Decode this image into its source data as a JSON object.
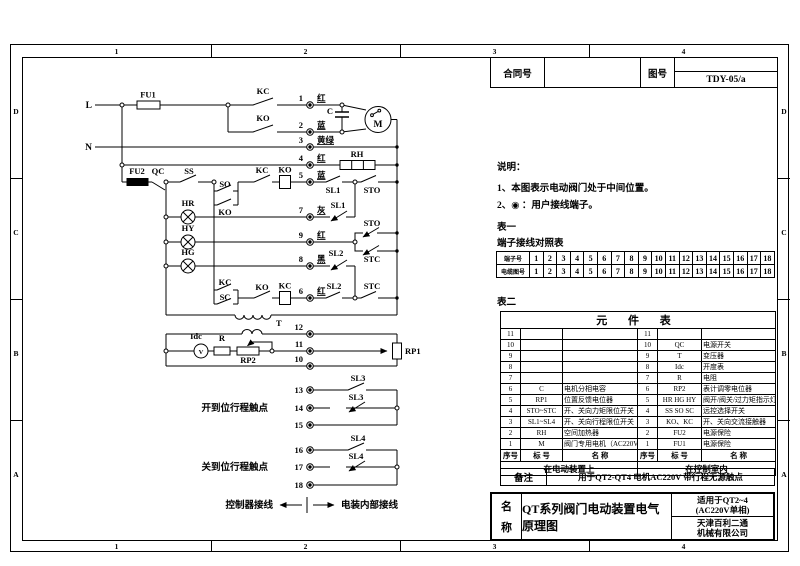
{
  "frame": {
    "zones_top": [
      "1",
      "2",
      "3",
      "4"
    ],
    "zones_bottom": [
      "1",
      "2",
      "3",
      "4"
    ],
    "zones_left": [
      "D",
      "C",
      "B",
      "A"
    ],
    "zones_right": [
      "D",
      "C",
      "B",
      "A"
    ]
  },
  "header": {
    "contract_label": "合同号",
    "drawing_label": "图号",
    "drawing_no": "TDY-05/a"
  },
  "notes": {
    "title": "说明：",
    "item1": "1、本图表示电动阀门处于中间位置。",
    "item2": "2、◉ ：用户接线端子。"
  },
  "table1": {
    "caption": "表一",
    "title": "端子接线对照表",
    "row1_label": "端子号",
    "row2_label": "电缆图号",
    "row1": [
      "1",
      "2",
      "3",
      "4",
      "5",
      "6",
      "7",
      "8",
      "9",
      "10",
      "11",
      "12",
      "13",
      "14",
      "15",
      "16",
      "17",
      "18"
    ],
    "row2": [
      "1",
      "2",
      "3",
      "4",
      "5",
      "6",
      "7",
      "8",
      "9",
      "10",
      "11",
      "12",
      "13",
      "14",
      "15",
      "16",
      "17",
      "18"
    ]
  },
  "table2": {
    "caption": "表二",
    "title": "元 件 表",
    "header": [
      "序号",
      "标 号",
      "名  称",
      "序号",
      "标 号",
      "名  称"
    ],
    "rows": [
      [
        "11",
        "",
        "",
        "11",
        "",
        ""
      ],
      [
        "10",
        "",
        "",
        "10",
        "QC",
        "电源开关"
      ],
      [
        "9",
        "",
        "",
        "9",
        "T",
        "变压器"
      ],
      [
        "8",
        "",
        "",
        "8",
        "Idc",
        "开度表"
      ],
      [
        "7",
        "",
        "",
        "7",
        "R",
        "电阻"
      ],
      [
        "6",
        "C",
        "电机分相电容",
        "6",
        "RP2",
        "表计调零电位器"
      ],
      [
        "5",
        "RP1",
        "位置反馈电位器",
        "5",
        "HR HG HY",
        "阀开/阀关/过力矩指示灯"
      ],
      [
        "4",
        "STO~STC",
        "开、关向力矩限位开关",
        "4",
        "SS SO SC",
        "远控选择开关"
      ],
      [
        "3",
        "SL1~SL4",
        "开、关向行程限位开关",
        "3",
        "KO、KC",
        "开、关向交流接触器"
      ],
      [
        "2",
        "RH",
        "空间加热器",
        "2",
        "FU2",
        "电源保险"
      ],
      [
        "1",
        "M",
        "阀门专用电机（AC220V）",
        "1",
        "FU1",
        "电源保险"
      ]
    ],
    "footer_left": "在电动装置上",
    "footer_right": "在控制室内"
  },
  "remarks": {
    "label": "备注",
    "text": "用于QT2-QT4  电机AC220V  带行程无源触点"
  },
  "titleblock": {
    "label_top": "名",
    "label_bottom": "称",
    "title": "QT系列阀门电动装置电气原理图",
    "applicable_line1": "适用于QT2~4",
    "applicable_line2": "(AC220V单相)",
    "company_line1": "天津百利二通",
    "company_line2": "机械有限公司"
  },
  "circuit": {
    "l": "L",
    "n": "N",
    "fu1": "FU1",
    "fu2": "FU2",
    "qc": "QC",
    "ss": "SS",
    "so": "SO",
    "ko_hold": "KO",
    "kc_motor": "KC",
    "ko_motor": "KO",
    "cap": "C",
    "motor": "M",
    "rh": "RH",
    "kc_interlock": "KC",
    "ko_coil": "KO",
    "hr": "HR",
    "hy": "HY",
    "hg": "HG",
    "kc_sel": "KC",
    "sc": "SC",
    "ko_interlock": "KO",
    "kc_coil": "KC",
    "sl1_no": "SL1",
    "sto_main": "STO",
    "sl1_nc": "SL1",
    "sto_ind": "STO",
    "stc_ind": "STC",
    "sl2_nc": "SL2",
    "sl2_no": "SL2",
    "stc_main": "STC",
    "t": "T",
    "idc": "Idc",
    "v": "V",
    "r": "R",
    "rp2": "RP2",
    "rp1": "RP1",
    "sl3_no": "SL3",
    "sl3_nc": "SL3",
    "sl4_no": "SL4",
    "sl4_nc": "SL4",
    "terminals": [
      "1",
      "2",
      "3",
      "4",
      "5",
      "6",
      "7",
      "8",
      "9",
      "10",
      "11",
      "12",
      "13",
      "14",
      "15",
      "16",
      "17",
      "18"
    ],
    "wire_colors": {
      "t1": "红",
      "t2": "蓝",
      "t3": "黄绿",
      "t4": "红",
      "t5": "蓝",
      "t6": "红",
      "t7": "灰",
      "t8": "黑",
      "t9": "红"
    },
    "open_limit_label": "开到位行程触点",
    "close_limit_label": "关到位行程触点",
    "external_label": "控制器接线",
    "internal_label": "电装内部接线"
  }
}
